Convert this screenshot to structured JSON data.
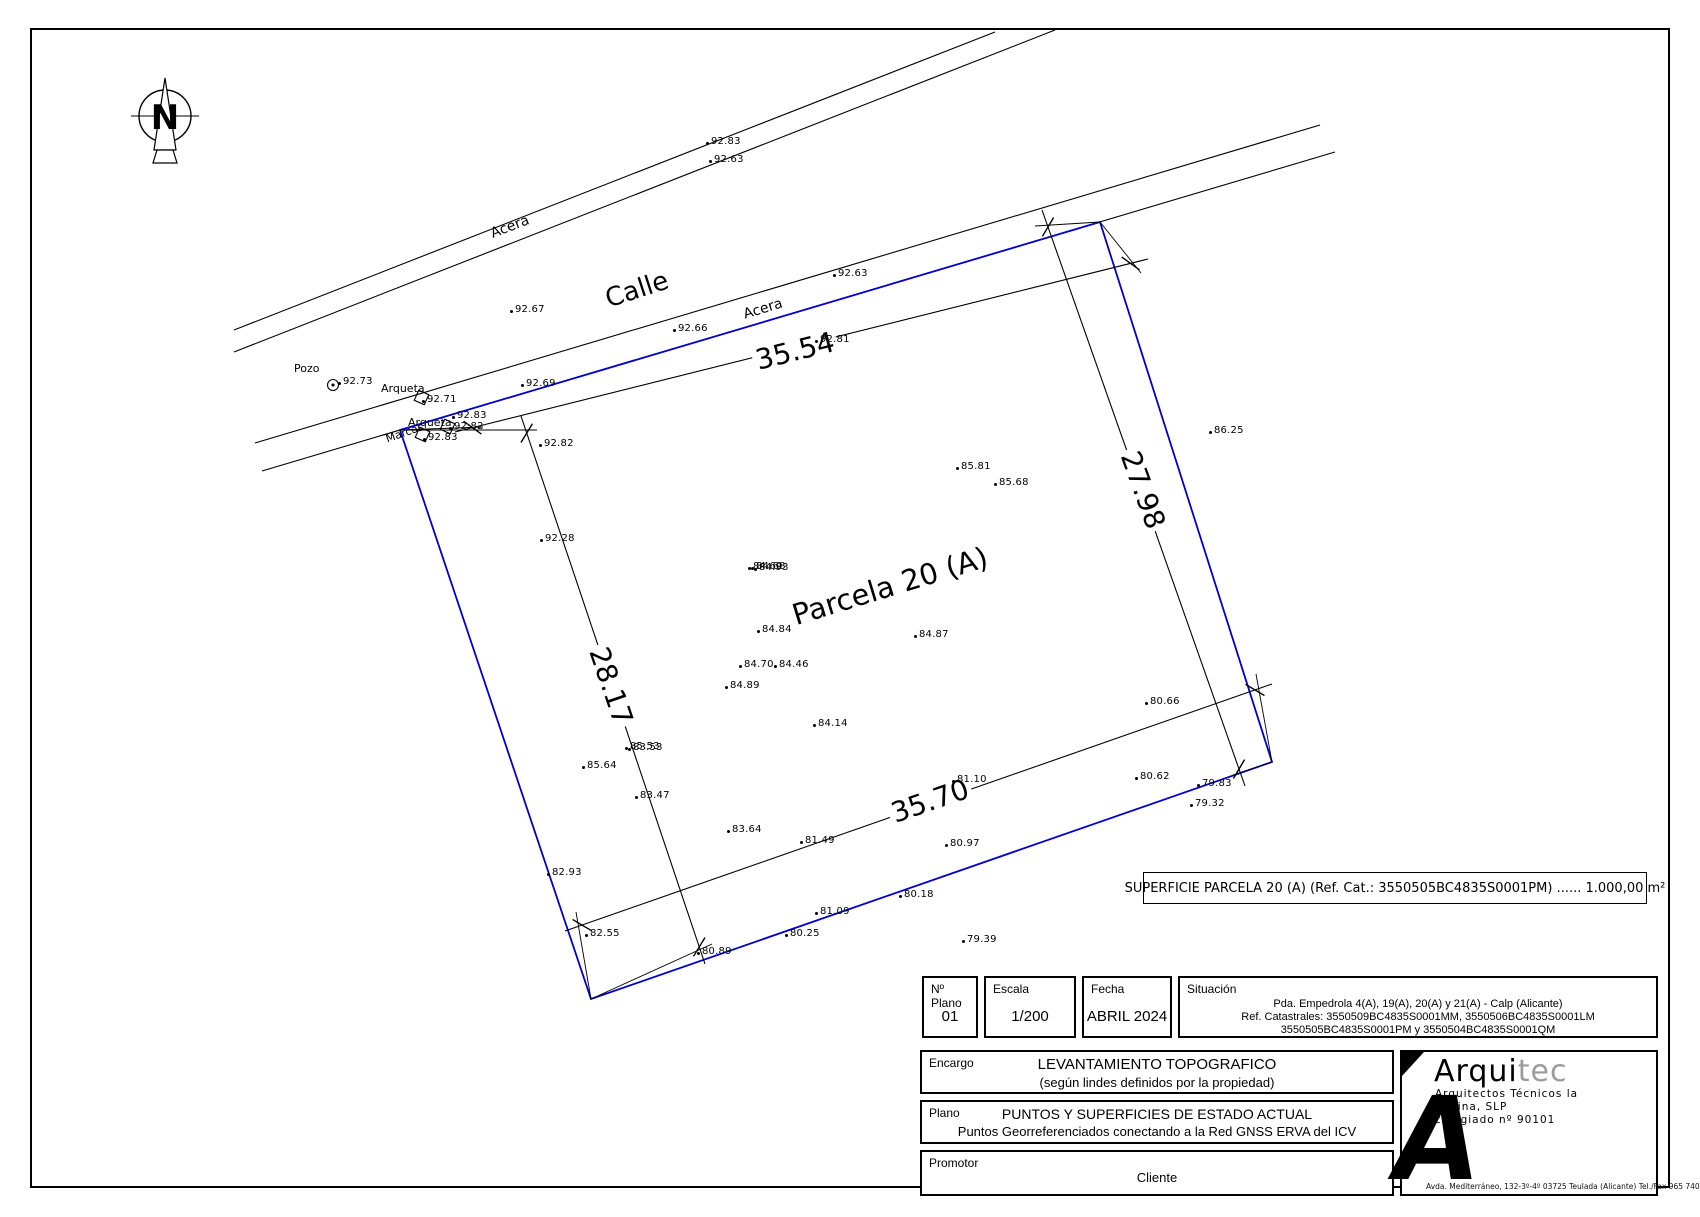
{
  "drawing": {
    "north_label": "N",
    "streets": [
      {
        "label": "Acera",
        "x": 510,
        "y": 227,
        "rot": -21,
        "cls": "acera-name"
      },
      {
        "label": "Calle",
        "x": 637,
        "y": 290,
        "rot": -18,
        "cls": "street-name"
      },
      {
        "label": "Acera",
        "x": 763,
        "y": 309,
        "rot": -17,
        "cls": "acera-name"
      }
    ],
    "parcel_title": {
      "label": "Parcela 20 (A)",
      "x": 890,
      "y": 586,
      "rot": -17
    },
    "boundary_color": "#0000cc",
    "dimensions": [
      {
        "value": "35.54",
        "x1": 455,
        "y1": 432,
        "x2": 1148,
        "y2": 259,
        "lx": 795,
        "ly": 351,
        "angle": -14
      },
      {
        "value": "27.98",
        "x1": 1042,
        "y1": 210,
        "x2": 1245,
        "y2": 786,
        "lx": 1143,
        "ly": 490,
        "angle": 70
      },
      {
        "value": "28.17",
        "x1": 521,
        "y1": 416,
        "x2": 705,
        "y2": 964,
        "lx": 611,
        "ly": 686,
        "angle": 71
      },
      {
        "value": "35.70",
        "x1": 565,
        "y1": 931,
        "x2": 1272,
        "y2": 684,
        "lx": 930,
        "ly": 801,
        "angle": -19
      }
    ],
    "features": [
      {
        "label": "Pozo",
        "x": 294,
        "y": 362,
        "rot": 0
      },
      {
        "label": "Arqueta",
        "x": 381,
        "y": 382,
        "rot": 0
      },
      {
        "label": "Arqueta",
        "x": 408,
        "y": 416,
        "rot": 0
      },
      {
        "label": "Marcas",
        "x": 384,
        "y": 433,
        "rot": -19
      }
    ],
    "survey_points": [
      {
        "v": "92.83",
        "x": 706,
        "y": 136
      },
      {
        "v": "92.63",
        "x": 709,
        "y": 154
      },
      {
        "v": "92.67",
        "x": 510,
        "y": 304
      },
      {
        "v": "92.66",
        "x": 673,
        "y": 323
      },
      {
        "v": "92.63",
        "x": 833,
        "y": 268
      },
      {
        "v": "92.81",
        "x": 815,
        "y": 334
      },
      {
        "v": "92.69",
        "x": 521,
        "y": 378
      },
      {
        "v": "92.73",
        "x": 338,
        "y": 376
      },
      {
        "v": "92.71",
        "x": 422,
        "y": 394
      },
      {
        "v": "92.83",
        "x": 452,
        "y": 410
      },
      {
        "v": "92.82",
        "x": 449,
        "y": 421
      },
      {
        "v": "92.83",
        "x": 423,
        "y": 432
      },
      {
        "v": "92.82",
        "x": 539,
        "y": 438
      },
      {
        "v": "92.28",
        "x": 540,
        "y": 533
      },
      {
        "v": "86.25",
        "x": 1209,
        "y": 425
      },
      {
        "v": "85.81",
        "x": 956,
        "y": 461
      },
      {
        "v": "85.68",
        "x": 994,
        "y": 477
      },
      {
        "v": "84.69",
        "x": 748,
        "y": 561
      },
      {
        "v": "84.68",
        "x": 751,
        "y": 561
      },
      {
        "v": "84.93",
        "x": 754,
        "y": 562
      },
      {
        "v": "84.84",
        "x": 757,
        "y": 624
      },
      {
        "v": "84.87",
        "x": 914,
        "y": 629
      },
      {
        "v": "84.70",
        "x": 739,
        "y": 659
      },
      {
        "v": "84.46",
        "x": 774,
        "y": 659
      },
      {
        "v": "84.89",
        "x": 725,
        "y": 680
      },
      {
        "v": "85.53",
        "x": 625,
        "y": 741
      },
      {
        "v": "83.53",
        "x": 628,
        "y": 742
      },
      {
        "v": "85.64",
        "x": 582,
        "y": 760
      },
      {
        "v": "83.47",
        "x": 635,
        "y": 790
      },
      {
        "v": "84.14",
        "x": 813,
        "y": 718
      },
      {
        "v": "83.64",
        "x": 727,
        "y": 824
      },
      {
        "v": "81.49",
        "x": 800,
        "y": 835
      },
      {
        "v": "82.93",
        "x": 547,
        "y": 867
      },
      {
        "v": "82.55",
        "x": 585,
        "y": 928
      },
      {
        "v": "80.89",
        "x": 697,
        "y": 946
      },
      {
        "v": "80.25",
        "x": 785,
        "y": 928
      },
      {
        "v": "81.09",
        "x": 815,
        "y": 906
      },
      {
        "v": "80.18",
        "x": 899,
        "y": 889
      },
      {
        "v": "80.97",
        "x": 945,
        "y": 838
      },
      {
        "v": "81.10",
        "x": 952,
        "y": 774
      },
      {
        "v": "80.66",
        "x": 1145,
        "y": 696
      },
      {
        "v": "80.62",
        "x": 1135,
        "y": 771
      },
      {
        "v": "79.83",
        "x": 1197,
        "y": 778
      },
      {
        "v": "79.32",
        "x": 1190,
        "y": 798
      },
      {
        "v": "79.39",
        "x": 962,
        "y": 934
      }
    ],
    "surface_note": "SUPERFICIE PARCELA 20 (A) (Ref. Cat.: 3550505BC4835S0001PM) ...... 1.000,00 m²"
  },
  "titleblock": {
    "nplano_label": "Nº Plano",
    "nplano_value": "01",
    "escala_label": "Escala",
    "escala_value": "1/200",
    "fecha_label": "Fecha",
    "fecha_value": "ABRIL 2024",
    "situacion_label": "Situación",
    "situacion_line1": "Pda. Empedrola 4(A), 19(A), 20(A) y 21(A) - Calp (Alicante)",
    "situacion_line2": "Ref. Catastrales: 3550509BC4835S0001MM, 3550506BC4835S0001LM",
    "situacion_line3": "3550505BC4835S0001PM y 3550504BC4835S0001QM",
    "encargo_label": "Encargo",
    "encargo_line1": "LEVANTAMIENTO TOPOGRAFICO",
    "encargo_line2": "(según lindes definidos por la propiedad)",
    "plano_label": "Plano",
    "plano_line1": "PUNTOS Y SUPERFICIES DE ESTADO ACTUAL",
    "plano_line2": "Puntos Georreferenciados conectando a la Red GNSS ERVA del ICV",
    "promotor_label": "Promotor",
    "promotor_value": "Cliente"
  },
  "logo": {
    "brand_black": "Arqui",
    "brand_gray": "tec",
    "sub1": "Arquitectos Técnicos la",
    "sub2": "Marina, SLP",
    "sub3": "colegiado nº 90101",
    "mark": "A",
    "address": "Avda. Mediterráneo, 132-3º-4º    03725 Teulada (Alicante)    Tel./Fax 965 740 326"
  }
}
